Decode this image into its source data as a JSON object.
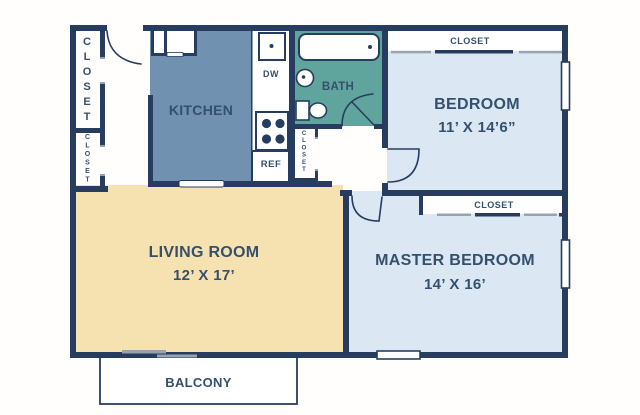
{
  "rooms": {
    "kitchen": {
      "label": "KITCHEN"
    },
    "bath": {
      "label": "BATH"
    },
    "bedroom": {
      "label": "BEDROOM",
      "dims": "11’ X 14’6”"
    },
    "living_room": {
      "label": "LIVING ROOM",
      "dims": "12’ X 17’"
    },
    "master_bedroom": {
      "label": "MASTER BEDROOM",
      "dims": "14’ X 16’"
    },
    "balcony": {
      "label": "BALCONY"
    }
  },
  "closets": {
    "entry_upper": {
      "label": "CLOSET"
    },
    "entry_lower": {
      "label": "CLOSET"
    },
    "hall": {
      "label": "CLOSET"
    },
    "bedroom_strip": {
      "label": "CLOSET"
    },
    "master_strip": {
      "label": "CLOSET"
    }
  },
  "appliances": {
    "dishwasher": {
      "label": "DW"
    },
    "refrigerator": {
      "label": "REF"
    }
  },
  "colors": {
    "wall": "#273d5f",
    "kitchen_fill": "#7191b0",
    "bath_fill": "#5fa59d",
    "bedroom_fill": "#dbe7f3",
    "living_fill": "#f6e2b0",
    "label_text": "#35506d",
    "slider_gray": "#97a3af",
    "background": "#fffefc"
  }
}
